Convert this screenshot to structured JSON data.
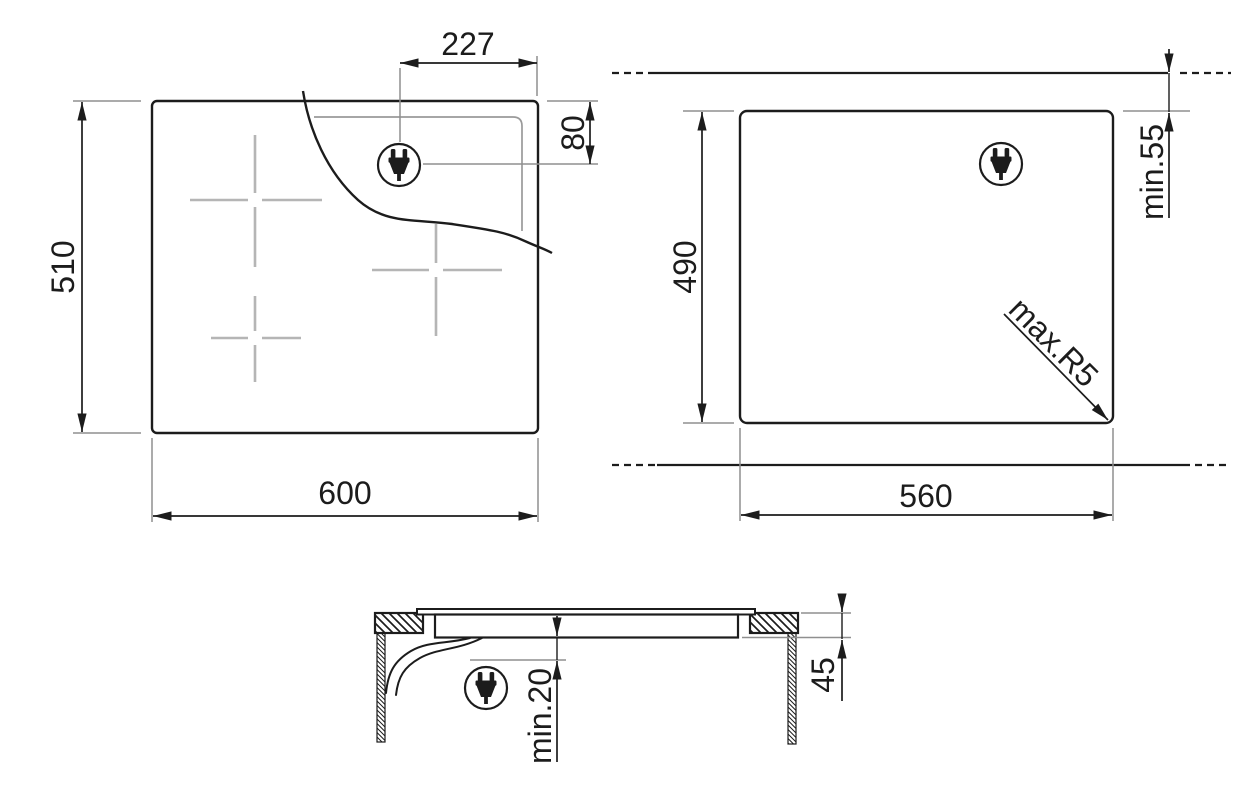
{
  "colors": {
    "line": "#1c1c1c",
    "extension_gray": "#8f8f8f",
    "cross_gray": "#b5b5b5",
    "background": "#ffffff"
  },
  "icons": {
    "power_plug": "power-plug"
  },
  "views": {
    "top": {
      "dim_plug_offset_x": "227",
      "dim_plug_offset_y": "80",
      "dim_height": "510",
      "dim_width": "600"
    },
    "cutout": {
      "dim_height": "490",
      "dim_rear_clearance": "min.55",
      "dim_corner_radius": "max.R5",
      "dim_width": "560"
    },
    "section": {
      "dim_thickness": "45",
      "dim_bottom_clearance": "min.20"
    }
  }
}
